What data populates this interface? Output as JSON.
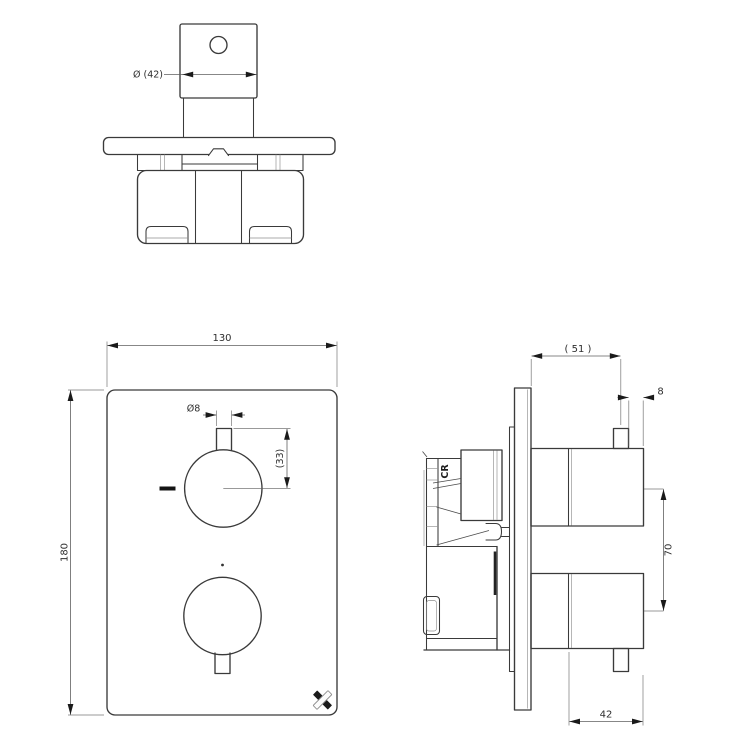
{
  "colors": {
    "background": "#ffffff",
    "outline": "#3a3a3a",
    "dimension": "#5f5f5f",
    "arrow": "#1a1a1a",
    "text": "#2e2e2e"
  },
  "views": {
    "top": {
      "label": "top-view",
      "dim_handle_width": "Ø (42)"
    },
    "front": {
      "label": "front-view",
      "dim_plate_width": "130",
      "dim_plate_height": "180",
      "dim_indicator_pin_diameter": "Ø8",
      "dim_pin_to_center": "(33)"
    },
    "side": {
      "label": "side-view",
      "dim_depth_from_wall": "( 51 )",
      "dim_pin_inset": "8",
      "dim_handle_centers": "70",
      "dim_handle_diameter": "42",
      "valve_body_mark": "CR"
    }
  },
  "brand": {
    "logo_icon": "crosswater-x-logo"
  }
}
